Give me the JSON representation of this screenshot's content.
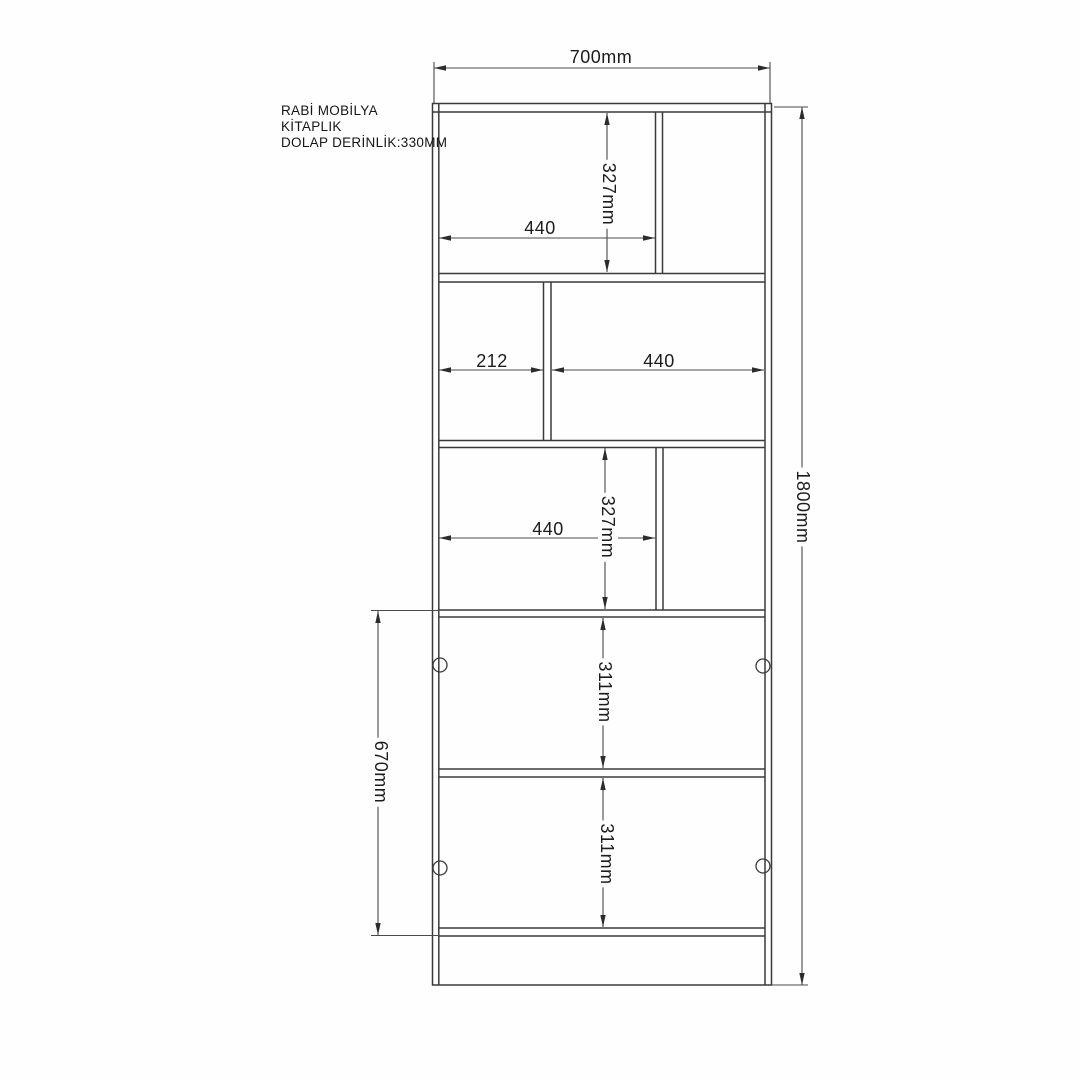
{
  "meta": {
    "drawing_type": "furniture technical drawing",
    "background_color": "#fefefe",
    "line_color": "#3a3a3a",
    "dim_line_color": "#4a4a4a",
    "text_color": "#1c1c1c"
  },
  "title_block": {
    "lines": [
      "RABİ MOBİLYA",
      "KİTAPLIK",
      "DOLAP DERİNLİK:330MM"
    ]
  },
  "dimensions": {
    "top_width": "700mm",
    "total_height": "1800mm",
    "lower_left_span": "670mm",
    "section1_width": "440",
    "section1_height": "327mm",
    "section2_width_left": "212",
    "section2_width_right": "440",
    "section3_width": "440",
    "section3_height": "327mm",
    "section4_height": "311mm",
    "section5_height": "311mm"
  }
}
